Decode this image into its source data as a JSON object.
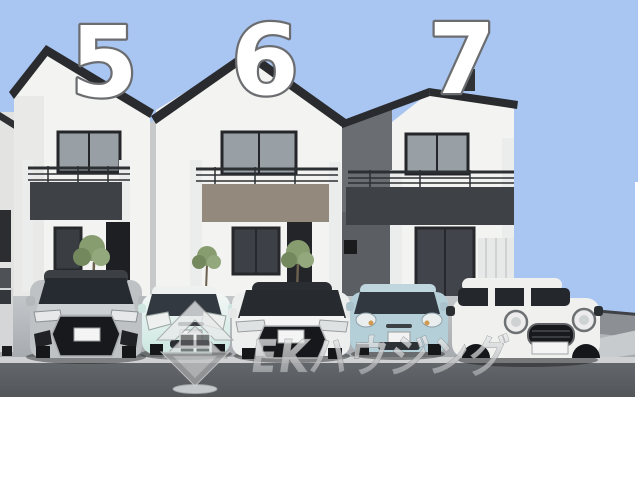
{
  "scene": {
    "description": "3D exterior rendering of three two-storey houses with parked cars in front, sky replaced by flat light blue",
    "sky_color": "#a9c5f2",
    "road_color": "#5a5d62",
    "driveway_color": "#b3b7ba",
    "wall_color": "#f3f3f1",
    "roof_color": "#292b2e",
    "accent_band_dark": "#3e4145",
    "accent_band_taupe": "#93897c"
  },
  "lot_numbers": [
    {
      "label": "5"
    },
    {
      "label": "6"
    },
    {
      "label": "7"
    }
  ],
  "watermark": {
    "brand_text": "EKハウジング",
    "logo_icon": "diamond-chevron-logo",
    "color": "#e8e9ea"
  },
  "numbers_style": {
    "fill": "#ffffff",
    "outline": "#6b6d70"
  },
  "cars": [
    {
      "slot": 0,
      "type": "partial-car-left-edge",
      "color": "#d4d6d8"
    },
    {
      "slot": 1,
      "type": "suv",
      "color": "#bfc2c5"
    },
    {
      "slot": 2,
      "type": "compact-hatchback",
      "color": "#cde8e1"
    },
    {
      "slot": 3,
      "type": "sedan",
      "color": "#edefee"
    },
    {
      "slot": 4,
      "type": "compact-hatchback",
      "color": "#b4cfd8"
    },
    {
      "slot": 5,
      "type": "crossover",
      "color": "#f0f1ef"
    }
  ]
}
